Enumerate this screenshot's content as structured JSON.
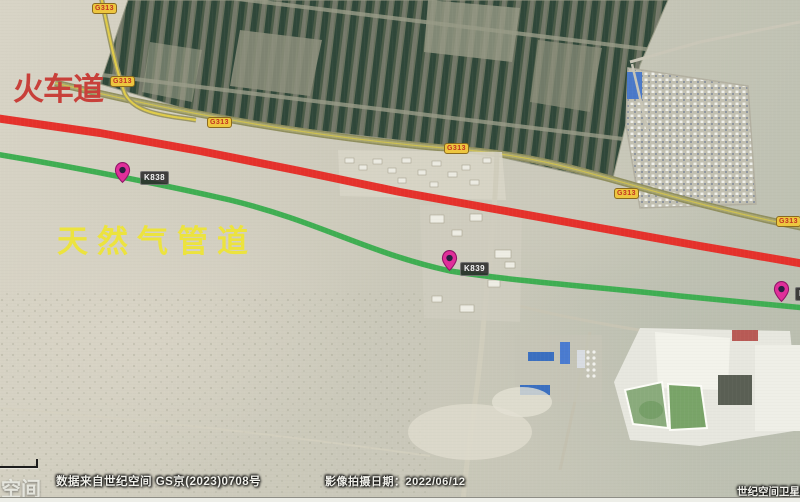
{
  "map": {
    "railway_label": "火车道",
    "pipeline_label": "天然气管道",
    "road_shield_label": "G313",
    "markers": [
      {
        "label": "K838"
      },
      {
        "label": "K839"
      },
      {
        "label": "K8"
      }
    ],
    "credits": {
      "data_source": "数据来自世纪空间 GS京(2023)0708号",
      "capture_date": "影像拍摄日期：2022/06/12",
      "brand_watermark": "世纪空间卫星影像",
      "partial_watermark_left": "空间"
    },
    "colors": {
      "railway_line": "#e5312b",
      "pipeline_line": "#3fae52",
      "railway_label_text": "#c8403a",
      "pipeline_label_text": "#ece33e",
      "road_shield_bg": "#edc63f",
      "road_shield_text": "#c23222",
      "marker_pin": "#e02f9a",
      "g313_road_centerline": "#e0cc4a"
    }
  }
}
